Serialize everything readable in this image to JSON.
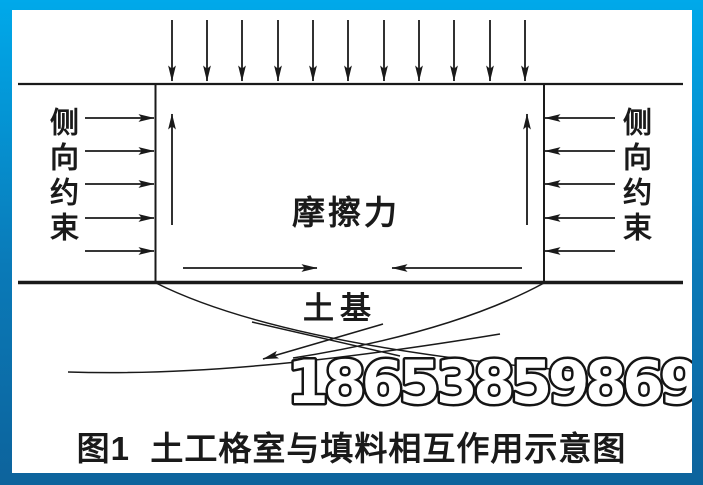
{
  "page": {
    "background": "#ffffff",
    "frame": {
      "top_color": "#00a9ea",
      "bottom_color": "#0d639c"
    }
  },
  "diagram": {
    "labels": {
      "left_constraint": "侧向约束",
      "right_constraint": "侧向约束",
      "friction": "摩擦力",
      "subgrade": "土基"
    },
    "watermark": "18653859869",
    "caption": "图1  土工格室与填料相互作用示意图",
    "line_color": "#1a1a1a",
    "arrow_counts": {
      "top_load": 11,
      "left_lateral": 5,
      "right_lateral": 5,
      "internal_vertical": 2,
      "internal_bottom": 2,
      "slip_surface": 1
    }
  }
}
